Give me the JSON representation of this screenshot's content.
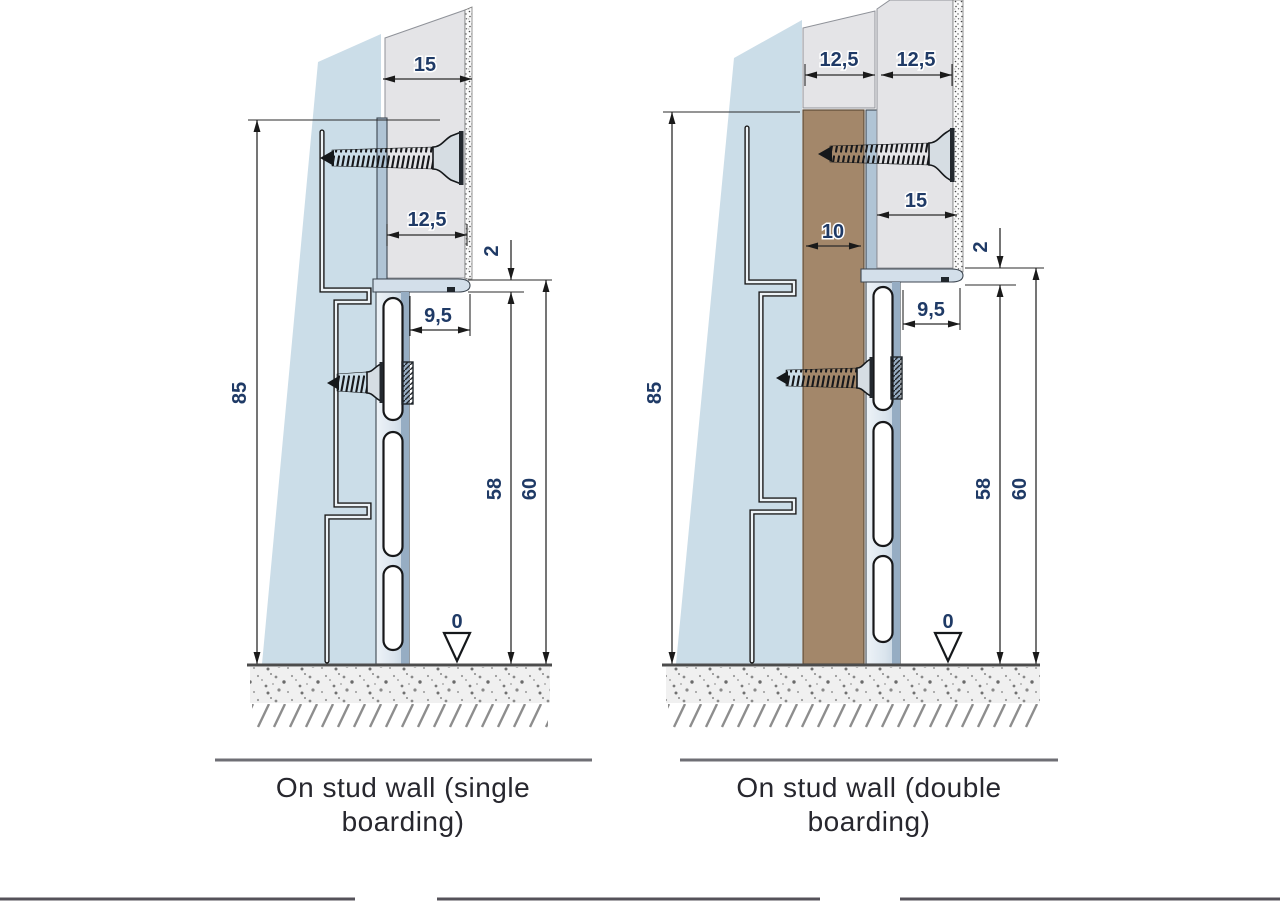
{
  "colors": {
    "stud_blue": "#cbdde8",
    "board_grey": "#e4e4e7",
    "strip_brown": "#a3876a",
    "profile_light": "#d3dfea",
    "profile_shade": "#96adc3",
    "dim_label": "#1f3a66"
  },
  "left": {
    "caption_line1": "On stud wall (single",
    "caption_line2": "boarding)",
    "dims": {
      "board_face": "15",
      "board": "12,5",
      "lip": "2",
      "reveal": "9,5",
      "height": "85",
      "web": "58",
      "total": "60",
      "level": "0"
    }
  },
  "right": {
    "caption_line1": "On stud wall (double",
    "caption_line2": "boarding)",
    "dims": {
      "board1": "12,5",
      "board2": "12,5",
      "face": "15",
      "strip": "10",
      "lip": "2",
      "reveal": "9,5",
      "height": "85",
      "web": "58",
      "total": "60",
      "level": "0"
    }
  }
}
